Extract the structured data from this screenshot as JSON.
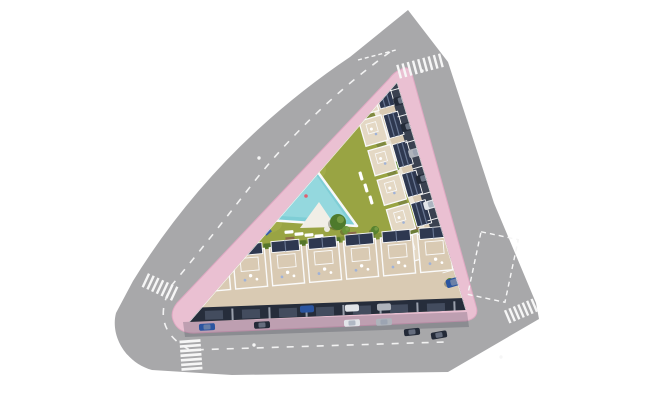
{
  "meta": {
    "title": "Aerial top-down architectural render of a triangular residential complex with pool, garden, townhouse rows and surrounding roads"
  },
  "colors": {
    "background": "#ffffff",
    "road": "#a8a8aa",
    "road_marking": "#f6f6f6",
    "sidewalk_pink": "#eac0d2",
    "sidewalk_pink_edge": "#dfa8c2",
    "curb_white": "#fafafa",
    "lawn": "#99a443",
    "lawn_light": "#aab351",
    "hedge_strip": "#7f9437",
    "hedge_bush": "#55762b",
    "pool_water": "#7fced6",
    "pool_water_light": "#9ddde1",
    "pool_rim": "#f8f8f8",
    "deck": "#f1eee6",
    "terrace_beige": "#d9cab3",
    "terrace_light": "#e4d8c4",
    "wall_white": "#fafafa",
    "roof_panel": "#2e3850",
    "roof_panel_stripe": "#6a7894",
    "facade_dark": "#262d3b",
    "garage_door": "#434c5e",
    "parking_asphalt": "#3a4150",
    "shadow": "rgba(35,42,60,0.22)",
    "tree_dark": "#4e7a2c",
    "tree_mid": "#57822f",
    "tree_light": "#6a9439",
    "bench_brown": "#8a6b4a",
    "car_navy": "#232a38",
    "car_blue": "#2b55a0",
    "car_white": "#e2e5e9",
    "car_silver": "#aeb3bb",
    "car_roof": "#8f9aab",
    "buoy_red": "#e06070",
    "furniture_white": "#ffffff",
    "furniture_blue": "#9fb2d8"
  },
  "roads": {
    "crosswalks": [
      {
        "name": "top",
        "cx": 420,
        "cy": 66,
        "angle": 75,
        "count": 9,
        "len": 14,
        "w": 2.4,
        "gap": 5.4
      },
      {
        "name": "left",
        "cx": 160,
        "cy": 287,
        "angle": 115,
        "count": 7,
        "len": 15,
        "w": 2.4,
        "gap": 5.2
      },
      {
        "name": "bottom",
        "cx": 191,
        "cy": 355,
        "angle": -4,
        "count": 7,
        "len": 21,
        "w": 2.7,
        "gap": 4.6
      },
      {
        "name": "right",
        "cx": 521,
        "cy": 311,
        "angle": 67,
        "count": 7,
        "len": 14,
        "w": 2.4,
        "gap": 4.8
      }
    ],
    "reflector_dots": [
      {
        "x": 259,
        "y": 158
      },
      {
        "x": 422,
        "y": 71
      },
      {
        "x": 254,
        "y": 345
      },
      {
        "x": 501,
        "y": 357
      }
    ],
    "parking_box": {
      "cx": 493,
      "cy": 267,
      "w": 38,
      "h": 64,
      "angle": 12
    }
  },
  "site": {
    "east_wing": {
      "units": 6
    },
    "bottom_row": {
      "units": 7,
      "garage_doors": 7
    },
    "trees": [
      {
        "x": 296,
        "y": 112,
        "r": 6,
        "c": "tree_dark"
      },
      {
        "x": 305,
        "y": 120,
        "r": 4.5,
        "c": "tree_light"
      },
      {
        "x": 288,
        "y": 105,
        "r": 4,
        "c": "tree_mid"
      },
      {
        "x": 338,
        "y": 222,
        "r": 8,
        "c": "tree_dark"
      },
      {
        "x": 346,
        "y": 230,
        "r": 4,
        "c": "tree_light"
      },
      {
        "x": 231,
        "y": 251,
        "r": 4,
        "c": "tree_mid"
      },
      {
        "x": 375,
        "y": 230,
        "r": 4,
        "c": "tree_mid"
      },
      {
        "x": 450,
        "y": 282,
        "r": 4,
        "c": "tree_mid"
      },
      {
        "x": 396,
        "y": 166,
        "r": 4.5,
        "c": "tree_mid"
      },
      {
        "x": 336,
        "y": 137,
        "r": 3.5,
        "c": "tree_light"
      },
      {
        "x": 302,
        "y": 96,
        "r": 3,
        "c": "tree_mid"
      }
    ],
    "benches": [
      {
        "x": 216,
        "y": 246
      },
      {
        "x": 290,
        "y": 239
      },
      {
        "x": 352,
        "y": 234
      },
      {
        "x": 414,
        "y": 228
      }
    ],
    "loungers_bottom": [
      {
        "x": 289,
        "y": 232
      },
      {
        "x": 299,
        "y": 234
      },
      {
        "x": 309,
        "y": 235
      },
      {
        "x": 319,
        "y": 236
      }
    ],
    "loungers_right": [
      {
        "x": 361,
        "y": 176
      },
      {
        "x": 366,
        "y": 188
      },
      {
        "x": 371,
        "y": 200
      }
    ],
    "planters": [
      {
        "x": 262,
        "y": 224,
        "c": "#3f7d4e"
      },
      {
        "x": 268,
        "y": 232,
        "c": "#3b5ea8"
      },
      {
        "x": 384,
        "y": 80,
        "c": "#3f7d4e"
      }
    ]
  },
  "cars": {
    "east": [
      "#232a38",
      "#232a38",
      "#aeb3bb",
      "#232a38",
      "#e2e5e9",
      "#232a38",
      "#232a38",
      "#2b55a0"
    ],
    "bottom_road": [
      {
        "x": 207,
        "y": 327,
        "a": -3,
        "c": "#2b55a0"
      },
      {
        "x": 262,
        "y": 325,
        "a": -3,
        "c": "#232a38"
      },
      {
        "x": 352,
        "y": 323,
        "a": -3,
        "c": "#e2e5e9"
      },
      {
        "x": 384,
        "y": 322,
        "a": -3,
        "c": "#aeb3bb"
      },
      {
        "x": 412,
        "y": 332,
        "a": -6,
        "c": "#232a38"
      },
      {
        "x": 439,
        "y": 335,
        "a": -10,
        "c": "#232a38"
      }
    ],
    "garage": [
      {
        "x": 307,
        "y": 309,
        "c": "#2b55a0"
      },
      {
        "x": 352,
        "y": 308,
        "c": "#e2e5e9"
      },
      {
        "x": 384,
        "y": 307,
        "c": "#aeb3bb"
      }
    ]
  }
}
